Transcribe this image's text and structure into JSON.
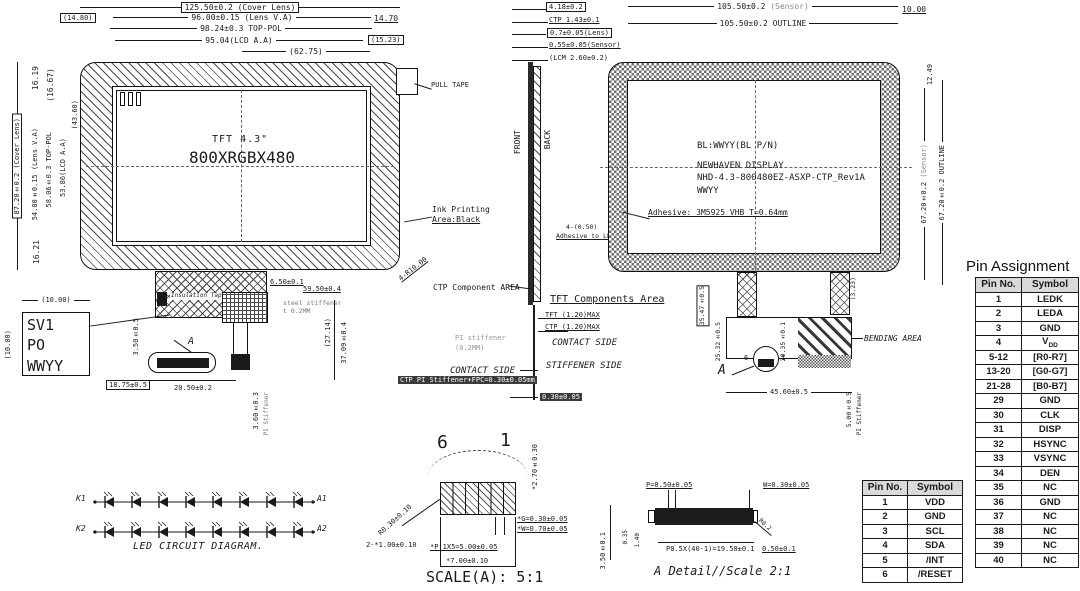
{
  "front": {
    "dim_width_cover": "125.50±0.2 (Cover Lens)",
    "dim_left_offset": "(14.80)",
    "dim_width_lens_va": "96.00±0.15 (Lens V.A)",
    "dim_right_offset": "14.70",
    "dim_width_top_pol": "98.24±0.3 TOP-POL",
    "dim_right_offset2": "(15.23)",
    "dim_width_lcd_aa": "95.04(LCD A.A)",
    "dim_width_center": "(62.75)",
    "dim_height_cover": "87.20±0.2 (Cover Lens)",
    "dim_16_19": "16.19",
    "dim_16_67": "(16.67)",
    "dim_height_lens_va": "54.80±0.15 (Lens V.A)",
    "dim_height_top_pol": "58.06±0.3 TOP-POL",
    "dim_height_lcd_aa": "53.86(LCD A.A)",
    "dim_43_60": "(43.60)",
    "dim_16_21": "16.21",
    "screen_line1": "TFT 4.3\"",
    "screen_line2": "800XRGBX480",
    "pull_tape": "PULL TAPE",
    "ink_note_line1": "Ink Printing",
    "ink_note_line2": "Area:Black",
    "corner_radius": "4-R10.00",
    "insulation_tape": "Insulation Tape",
    "steel_stiffener_line1": "steel stiffener",
    "steel_stiffener_line2": "t 0.2MM",
    "dim_6_50": "6.50±0.1",
    "dim_59_50": "59.50±0.4",
    "dim_27_14": "(27.14)",
    "dim_37_09": "37.09±0.4",
    "dim_3_50": "3.50±0.5",
    "dim_18_75": "18.75±0.5",
    "dim_20_50": "20.50±0.2",
    "dim_3_60": "3.60±0.3",
    "pi_stiffener_note": "PI Stiffener",
    "detail_ref": "A"
  },
  "label_box": {
    "line1": "SV1",
    "line2": "PO",
    "line3": "WWYY",
    "dim_width": "(10.00)",
    "dim_height": "(10.00)"
  },
  "side": {
    "dim_total": "4.18±0.2",
    "dim_ctp": "CTP 1.43±0.1",
    "dim_lens": "0.7±0.05(Lens)",
    "dim_sensor": "0.55±0.05(Sensor)",
    "dim_lcm": "(LCM 2.60±0.2)",
    "front_label": "FRONT",
    "back_label": "BACK",
    "adhesive_line1": "4-(0.50)",
    "adhesive_line2": "Adhesive to LENS",
    "ctp_component_area": "CTP Component AREA",
    "tft_components_area": "TFT Components Area",
    "tft_max": "TFT (1.20)MAX",
    "ctp_max": "CTP (1.20)MAX",
    "pi_stiffener_line1": "PI stiffener",
    "pi_stiffener_line2": "(0.2MM)",
    "contact_side_right": "CONTACT SIDE",
    "stiffener_side": "STIFFENER SIDE",
    "contact_side_left": "CONTACT SIDE",
    "fpc_stack": "CTP PI Stiffener+FPC=0.30±0.05mm",
    "dim_0_30": "0.30±0.05"
  },
  "back": {
    "dim_width_sensor": "105.50±0.2",
    "dim_width_sensor_suffix": "(Sensor)",
    "dim_width_outline": "105.50±0.2 OUTLINE",
    "dim_10_00": "10.00",
    "dim_12_49": "12.49",
    "dim_height_sensor": "67.20±0.2",
    "dim_height_sensor_suffix": "(Sensor)",
    "dim_height_outline": "67.20±0.2 OUTLINE",
    "bl_line": "BL:WWYY(BL P/N)",
    "brand_line": "NEWHAVEN DISPLAY",
    "part_line": "NHD-4.3-800480EZ-ASXP-CTP_Rev1A",
    "date_line": "WWYY",
    "adhesive_note": "Adhesive: 3M5925 VHB T=0.64mm",
    "dim_35_47": "35.47±0.5",
    "dim_25_32": "25.32±0.5",
    "dim_20_35": "20.35±0.1",
    "dim_3_23": "(3.23)",
    "bending_area": "BENDING AREA",
    "dim_45_60": "45.60±0.5",
    "dim_5_00": "5.00±0.5",
    "pi_stiffener_note": "PI Stiffener",
    "detail_ref": "A",
    "pin6": "6",
    "pin1": "1"
  },
  "led": {
    "k1": "K1",
    "a1": "A1",
    "k2": "K2",
    "a2": "A2",
    "caption": "LED CIRCUIT DIAGRAM.",
    "diodes_per_row": 8
  },
  "connector_detail": {
    "pin6": "6",
    "pin1": "1",
    "dim_height": "*2.70±0.30",
    "dim_radius": "R0.30±0.10",
    "dim_end_pads": "2-*1.00±0.10",
    "dim_pitch": "*P 1X5=5.00±0.05",
    "dim_gap": "*G=0.30±0.05",
    "dim_pad_width": "*W=0.70±0.05",
    "dim_width": "*7.00±0.10",
    "caption": "SCALE(A): 5:1"
  },
  "a_detail": {
    "dim_pitch": "P=0.50±0.05",
    "dim_pad": "W=0.30±0.05",
    "dim_3_50": "3.50±0.1",
    "dim_0_35": "0.35",
    "dim_1_40": "1.40",
    "dim_length": "P0.5X(40-1)=19.50±0.1",
    "dim_0_50": "0.50±0.1",
    "dim_radius": "R0.2",
    "caption": "A Detail//Scale 2:1"
  },
  "pin_assignment": {
    "title": "Pin Assignment",
    "headers": [
      "Pin No.",
      "Symbol"
    ],
    "ctp_rows": [
      [
        "1",
        "VDD"
      ],
      [
        "2",
        "GND"
      ],
      [
        "3",
        "SCL"
      ],
      [
        "4",
        "SDA"
      ],
      [
        "5",
        "/INT"
      ],
      [
        "6",
        "/RESET"
      ]
    ],
    "main_rows": [
      [
        "1",
        "LEDK"
      ],
      [
        "2",
        "LEDA"
      ],
      [
        "3",
        "GND"
      ],
      [
        "4",
        "V~DD"
      ],
      [
        "5-12",
        "[R0-R7]"
      ],
      [
        "13-20",
        "[G0-G7]"
      ],
      [
        "21-28",
        "[B0-B7]"
      ],
      [
        "29",
        "GND"
      ],
      [
        "30",
        "CLK"
      ],
      [
        "31",
        "DISP"
      ],
      [
        "32",
        "HSYNC"
      ],
      [
        "33",
        "VSYNC"
      ],
      [
        "34",
        "DEN"
      ],
      [
        "35",
        "NC"
      ],
      [
        "36",
        "GND"
      ],
      [
        "37",
        "NC"
      ],
      [
        "38",
        "NC"
      ],
      [
        "39",
        "NC"
      ],
      [
        "40",
        "NC"
      ]
    ]
  }
}
